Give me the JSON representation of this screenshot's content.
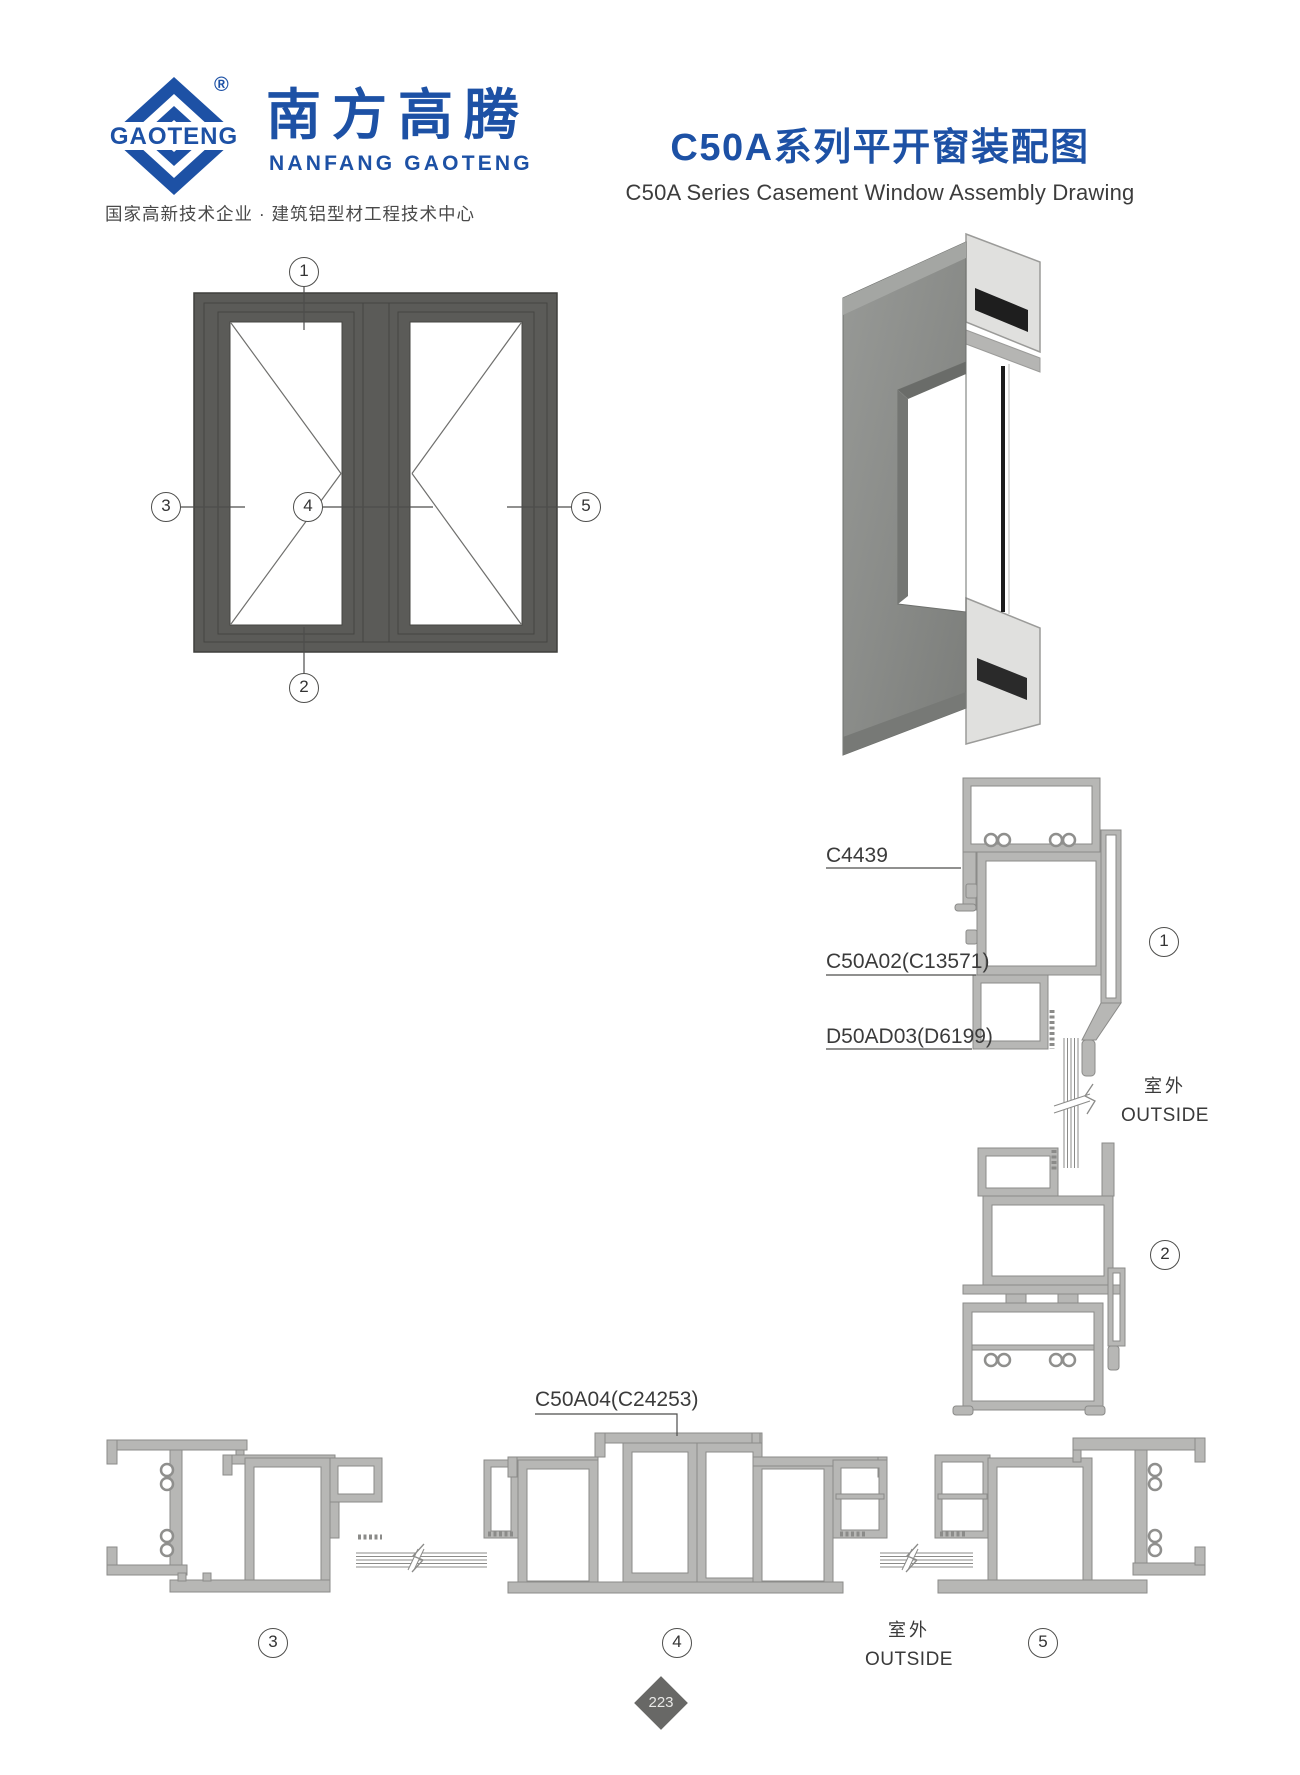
{
  "header": {
    "logo": {
      "diamond_text": "GAOTENG",
      "registered_mark": "®",
      "brand_cn": "南方高腾",
      "brand_en": "NANFANG GAOTENG",
      "tagline": "国家高新技术企业 · 建筑铝型材工程技术中心"
    },
    "title_cn": "C50A系列平开窗装配图",
    "title_en": "C50A Series Casement Window Assembly Drawing"
  },
  "callouts": {
    "elevation_top": "1",
    "elevation_bottom": "2",
    "elevation_left": "3",
    "elevation_center": "4",
    "elevation_right": "5",
    "section_head": "1",
    "section_sill": "2",
    "section_left_jamb": "3",
    "section_mullion": "4",
    "section_right_jamb": "5"
  },
  "part_labels": {
    "head_bead": "C4439",
    "frame_profile": "C50A02(C13571)",
    "sash_profile": "D50AD03(D6199)",
    "mullion_profile": "C50A04(C24253)"
  },
  "annotations": {
    "outside_cn": "室外",
    "outside_en": "OUTSIDE"
  },
  "footer": {
    "page_number": "223"
  }
}
